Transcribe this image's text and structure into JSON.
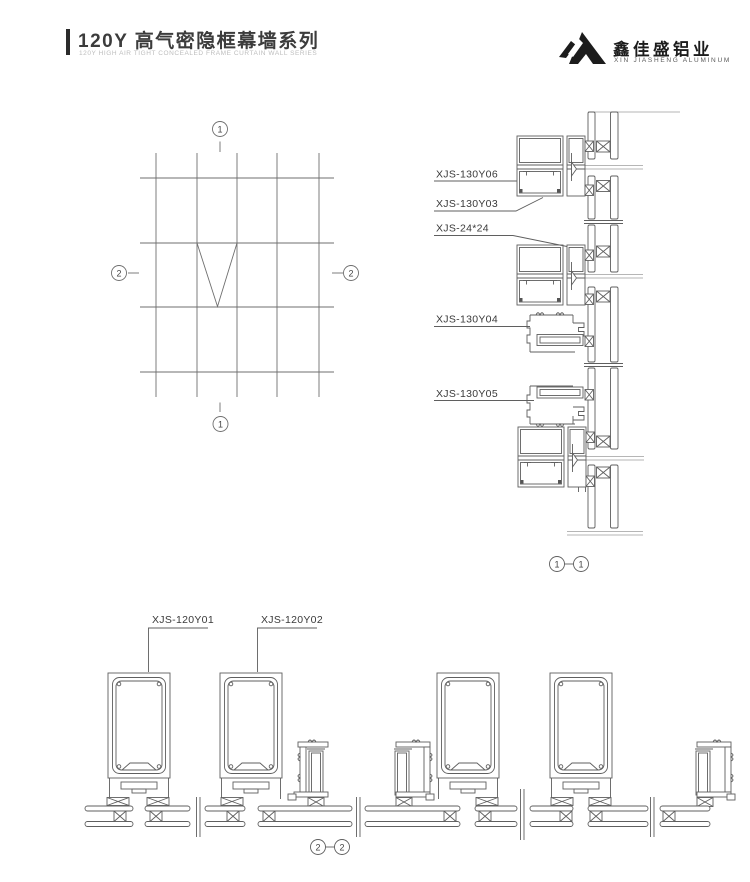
{
  "header": {
    "title": "120Y 高气密隐框幕墙系列",
    "subtitle": "120Y HIGH AIR TIGHT CONCEALED FRAME CURTAIN WALL SERIES",
    "logo": {
      "company": "鑫佳盛铝业",
      "company_en": "XIN JIASHENG ALUMINUM"
    }
  },
  "elevation": {
    "marker_top": "1",
    "marker_bottom": "1",
    "marker_left": "2",
    "marker_right": "2"
  },
  "vertical_section": {
    "callouts": [
      "XJS-130Y06",
      "XJS-130Y03",
      "XJS-24*24",
      "XJS-130Y04",
      "XJS-130Y05"
    ],
    "ref_left": "1",
    "ref_right": "1"
  },
  "horizontal_section": {
    "callouts": [
      "XJS-120Y01",
      "XJS-120Y02"
    ],
    "ref_left": "2",
    "ref_right": "2"
  },
  "colors": {
    "accent": "#2b2b2b",
    "line": "#5f5f5f",
    "line_light": "#9e9e9e",
    "grid": "#6f6f6f",
    "text": "#3a3a3a",
    "subtitle": "#bdbdbd",
    "logo": "#1c1c1c"
  }
}
